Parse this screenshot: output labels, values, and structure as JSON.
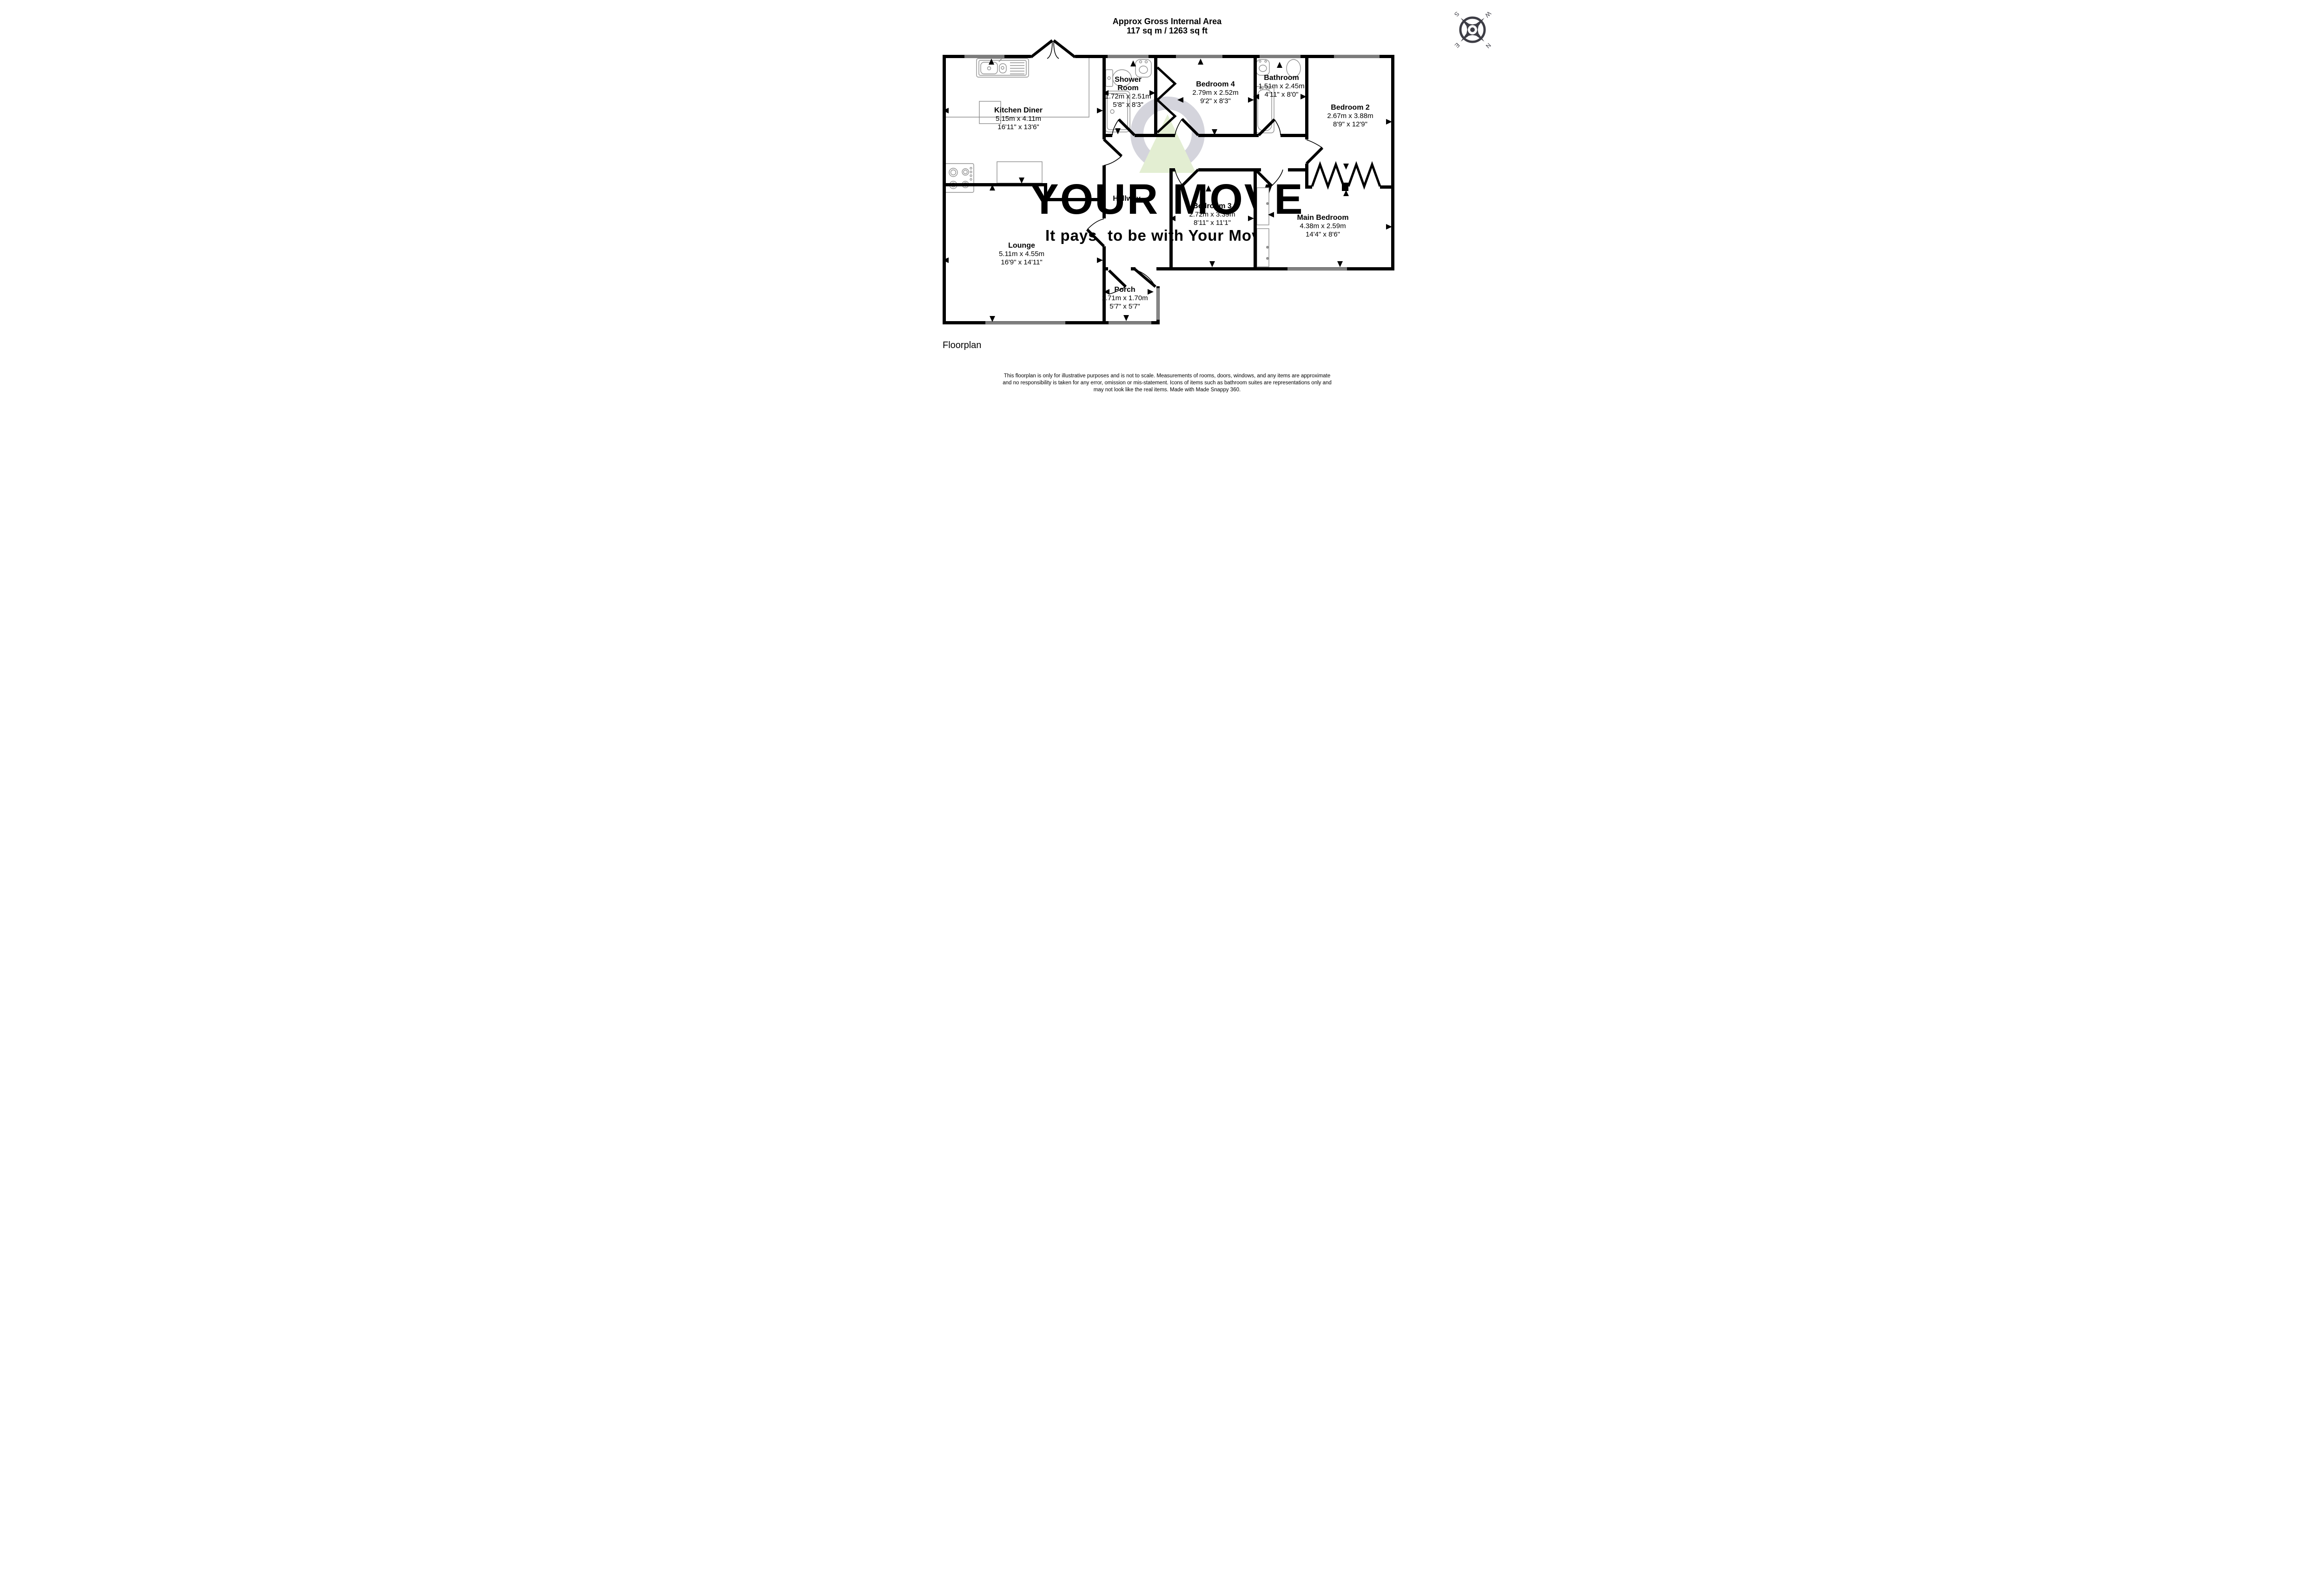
{
  "header": {
    "title_line1": "Approx Gross Internal Area",
    "title_line2": "117 sq m / 1263 sq ft"
  },
  "rooms": {
    "kitchen": {
      "name": "Kitchen Diner",
      "metric": "5.15m x 4.11m",
      "imperial": "16'11\" x 13'6\""
    },
    "shower": {
      "name_line1": "Shower",
      "name_line2": "Room",
      "metric": "1.72m x 2.51m",
      "imperial": "5'8\" x 8'3\""
    },
    "bedroom4": {
      "name": "Bedroom 4",
      "metric": "2.79m x 2.52m",
      "imperial": "9'2\" x 8'3\""
    },
    "bathroom": {
      "name": "Bathroom",
      "metric": "1.51m x 2.45m",
      "imperial": "4'11\" x 8'0\""
    },
    "bedroom2": {
      "name": "Bedroom 2",
      "metric": "2.67m x 3.88m",
      "imperial": "8'9\" x 12'9\""
    },
    "hallway": {
      "name": "Hallway"
    },
    "bedroom3": {
      "name": "Bedroom 3",
      "metric": "2.72m x 3.39m",
      "imperial": "8'11\" x 11'1\""
    },
    "main_bedroom": {
      "name": "Main Bedroom",
      "metric": "4.38m x 2.59m",
      "imperial": "14'4\" x 8'6\""
    },
    "lounge": {
      "name": "Lounge",
      "metric": "5.11m x 4.55m",
      "imperial": "16'9\" x 14'11\""
    },
    "porch": {
      "name": "Porch",
      "metric": "1.71m x 1.70m",
      "imperial": "5'7\" x 5'7\""
    }
  },
  "watermark": {
    "brand": "YOUR MOVE",
    "tagline_gray": "It pays",
    "tagline_green": "to be with Your Move"
  },
  "compass": {
    "north": "N",
    "south": "S",
    "east": "E",
    "west": "W"
  },
  "footer": {
    "caption": "Floorplan",
    "disclaimer_line1": "This floorplan is only for illustrative purposes and is not to scale. Measurements of rooms, doors, windows, and any items are approximate",
    "disclaimer_line2": "and no responsibility is taken for any error, omission or mis-statement. Icons of items such as bathroom suites are representations only and",
    "disclaimer_line3": "may not look like the real items. Made with Made Snappy 360."
  },
  "colors": {
    "wall": "#000000",
    "fixture_outline": "#8f8f8f",
    "watermark_gray": "#d4d4dc",
    "watermark_green": "#dfedca",
    "logo_green": "#e3eed2",
    "compass": "#3d3d45"
  }
}
